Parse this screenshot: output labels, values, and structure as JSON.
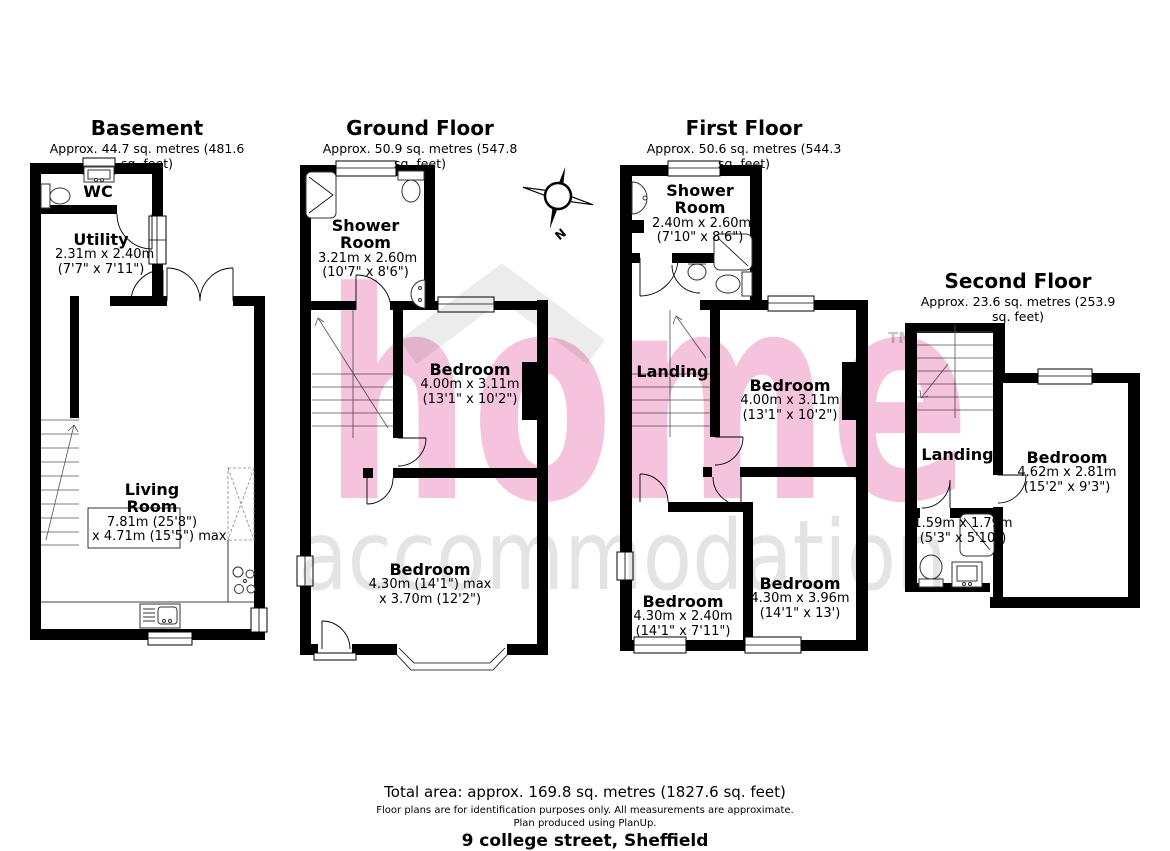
{
  "floors": [
    {
      "id": "basement",
      "title": "Basement",
      "area": "Approx. 44.7 sq. metres (481.6 sq. feet)",
      "rooms": [
        {
          "name": "WC",
          "dims": []
        },
        {
          "name": "Utility",
          "dims": [
            "2.31m x 2.40m",
            "(7'7\" x 7'11\")"
          ]
        },
        {
          "name": "Living Room",
          "dims": [
            "7.81m (25'8\")",
            "x 4.71m (15'5\") max"
          ]
        }
      ]
    },
    {
      "id": "ground-floor",
      "title": "Ground Floor",
      "area": "Approx. 50.9 sq. metres (547.8 sq. feet)",
      "rooms": [
        {
          "name": "Shower Room",
          "dims": [
            "3.21m x 2.60m",
            "(10'7\" x 8'6\")"
          ]
        },
        {
          "name": "Bedroom",
          "dims": [
            "4.00m x 3.11m",
            "(13'1\" x 10'2\")"
          ]
        },
        {
          "name": "Bedroom",
          "dims": [
            "4.30m (14'1\") max",
            "x 3.70m (12'2\")"
          ]
        }
      ]
    },
    {
      "id": "first-floor",
      "title": "First Floor",
      "area": "Approx. 50.6 sq. metres (544.3 sq. feet)",
      "rooms": [
        {
          "name": "Shower Room",
          "dims": [
            "2.40m x 2.60m",
            "(7'10\" x 8'6\")"
          ]
        },
        {
          "name": "Landing",
          "dims": []
        },
        {
          "name": "Bedroom",
          "dims": [
            "4.00m x 3.11m",
            "(13'1\" x 10'2\")"
          ]
        },
        {
          "name": "Bedroom",
          "dims": [
            "4.30m x 2.40m",
            "(14'1\" x 7'11\")"
          ]
        },
        {
          "name": "Bedroom",
          "dims": [
            "4.30m x 3.96m",
            "(14'1\" x 13')"
          ]
        }
      ]
    },
    {
      "id": "second-floor",
      "title": "Second Floor",
      "area": "Approx. 23.6 sq. metres (253.9 sq. feet)",
      "rooms": [
        {
          "name": "Landing",
          "dims": []
        },
        {
          "name": "",
          "dims": [
            "1.59m x 1.79m",
            "(5'3\" x 5'10\")"
          ]
        },
        {
          "name": "Bedroom",
          "dims": [
            "4.62m x 2.81m",
            "(15'2\" x 9'3\")"
          ]
        }
      ]
    }
  ],
  "compass": {
    "label": "N"
  },
  "watermark": {
    "word1": "home",
    "tm": "TM",
    "word2": "accommodation",
    "pink": "#f5c3dc",
    "gray": "#e4e4e4",
    "tm_gray": "#c8c8c8",
    "roof_gray": "#ececec"
  },
  "footer": {
    "total": "Total area: approx. 169.8 sq. metres (1827.6 sq. feet)",
    "disclaimer": "Floor plans are for identification purposes only. All measurements are approximate.",
    "producer": "Plan produced using PlanUp.",
    "address": "9 college street, Sheffield"
  }
}
